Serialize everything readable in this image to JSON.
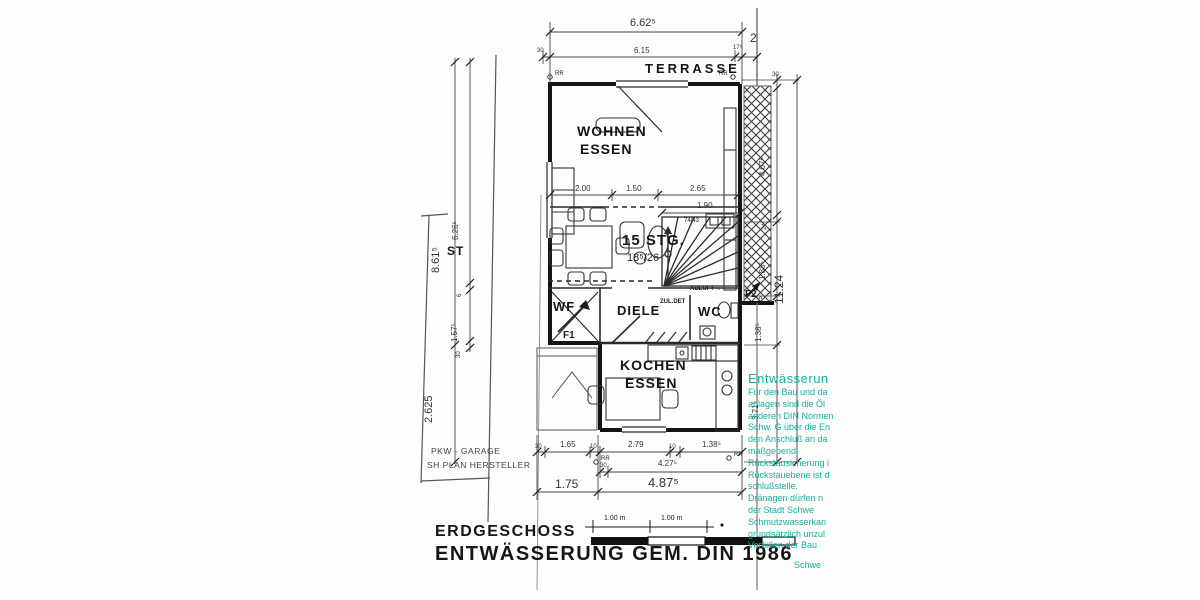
{
  "title_block": {
    "floor": "ERDGESCHOSS",
    "subtitle": "ENTWÄSSERUNG GEM. DIN 1986"
  },
  "rooms": {
    "terrasse": "TERRASSE",
    "wohnen": "WOHNEN",
    "essen_top": "ESSEN",
    "stairs_count": "15 STG.",
    "stairs_rise": "18⁵/26",
    "diele": "DIELE",
    "wf": "WF",
    "wc": "WC",
    "kochen": "KOCHEN",
    "essen_bottom": "ESSEN",
    "st": "ST",
    "garage_line1": "PKW - GARAGE",
    "garage_line2": "SH PLAN HERSTELLER"
  },
  "annotations": {
    "f1": "F1",
    "f2": "F2",
    "abluft": "ABLUFT →",
    "zuluft": "ZUL.DET",
    "window_size": "74/43",
    "rr": "RR",
    "boundary_strip": "2"
  },
  "dims": {
    "top_total": "6.62⁵",
    "top_30": "30",
    "top_615": "6.15",
    "top_175": "17⁵",
    "w_200": "2.00",
    "w_150": "1.50",
    "w_265": "2.65",
    "stair_190": "1.90",
    "b1_30": "30",
    "b1_165": "1.65",
    "b1_10a": "10",
    "b1_279": "2.79",
    "b1_10b": "10",
    "b1_1385": "1.38⁵",
    "b2_30": "30",
    "b2_4275": "4.27⁵",
    "b3_175": "1.75",
    "b3_4875": "4.87⁵",
    "l_8615": "8.61⁵",
    "l_2625": "2.625",
    "l_6265": "6.26⁵",
    "l_6": "6",
    "l_1575": "1.57⁵",
    "l_30": "30",
    "r_30": "30",
    "r_4075": "4.07⁵",
    "r_24": "24",
    "r_1885": "1.88⁵",
    "r_25": "25",
    "r_1385": "1.38⁵",
    "r_3715": "3.71⁵",
    "r_total": "11.24"
  },
  "scale_bar": {
    "seg1": "1.00 m",
    "seg2": "1.00 m"
  },
  "notes": {
    "color": "#14b2a0",
    "lines": [
      "Entwässerun",
      "Für den Bau und da",
      "anlagen sind die Öl",
      "anderen DIN Normen",
      "Schw. G über die En",
      "den Anschluß an da",
      "maßgebend.",
      "Rückstausicherung i",
      "Rückstauebene ist d",
      "schlußstelle.",
      "Dränagen dürfen n",
      "der Stadt Schwe",
      "Schmutzwasserkan",
      "grundsätzlich unzul",
      "Verfüllen der Bau",
      "Schwe"
    ]
  }
}
